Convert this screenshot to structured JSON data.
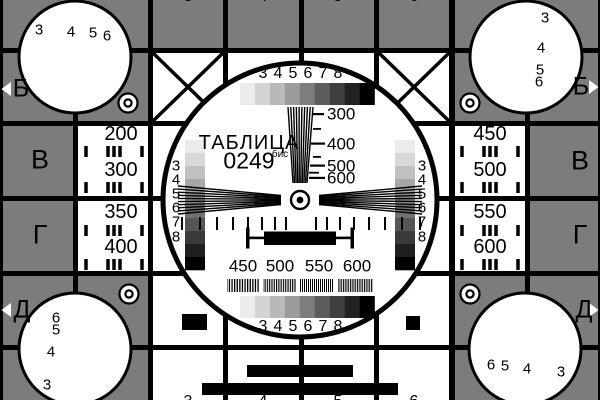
{
  "card": {
    "title": "ТАБЛИЦА",
    "code": "0249",
    "code_suffix": "бис"
  },
  "edge_markers": {
    "left": [
      "Б",
      "В",
      "Г",
      "Д"
    ],
    "right": [
      "Б",
      "В",
      "Г",
      "Д"
    ]
  },
  "clipped_column_digits": {
    "top": [
      "3",
      "4",
      "5",
      "6"
    ],
    "bottom": [
      "3",
      "4",
      "5",
      "6"
    ]
  },
  "left_panel": {
    "values": [
      "200",
      "300",
      "350",
      "400"
    ]
  },
  "right_panel": {
    "values": [
      "450",
      "500",
      "550",
      "600"
    ]
  },
  "circle": {
    "gray_scale_labels_top": [
      "3",
      "4",
      "5",
      "6",
      "7",
      "8"
    ],
    "gray_scale_labels_bottom": [
      "3",
      "4",
      "5",
      "6",
      "7",
      "8"
    ],
    "vertical_scale_labels_left": [
      "3",
      "4",
      "5",
      "6",
      "7",
      "8"
    ],
    "vertical_scale_labels_right": [
      "3",
      "4",
      "5",
      "6",
      "7",
      "8"
    ],
    "wedge_scale_labels": [
      "300",
      "400",
      "500",
      "600"
    ],
    "burst_labels": [
      "450",
      "500",
      "550",
      "600"
    ]
  },
  "corner_circles": {
    "top_left_labels": [
      "3",
      "4",
      "5",
      "6"
    ],
    "top_right_labels": [
      "3",
      "4",
      "5",
      "6"
    ],
    "bottom_left_labels": [
      "6",
      "5",
      "4",
      "3"
    ],
    "bottom_right_labels": [
      "6",
      "5",
      "4",
      "3"
    ]
  },
  "colors": {
    "background": "#000000",
    "panel_gray": "#7c7c7c",
    "white": "#ffffff",
    "grayscale_steps": [
      "#ececec",
      "#d4d4d4",
      "#b9b9b9",
      "#9c9c9c",
      "#7d7d7d",
      "#5d5d5d",
      "#3f3f3f",
      "#222222",
      "#000000"
    ],
    "vertical_grayscale_steps": [
      "#ececec",
      "#d8d8d8",
      "#c0c0c0",
      "#a7a7a7",
      "#8d8d8d",
      "#717171",
      "#555555",
      "#3a3a3a",
      "#1f1f1f",
      "#000000"
    ]
  }
}
